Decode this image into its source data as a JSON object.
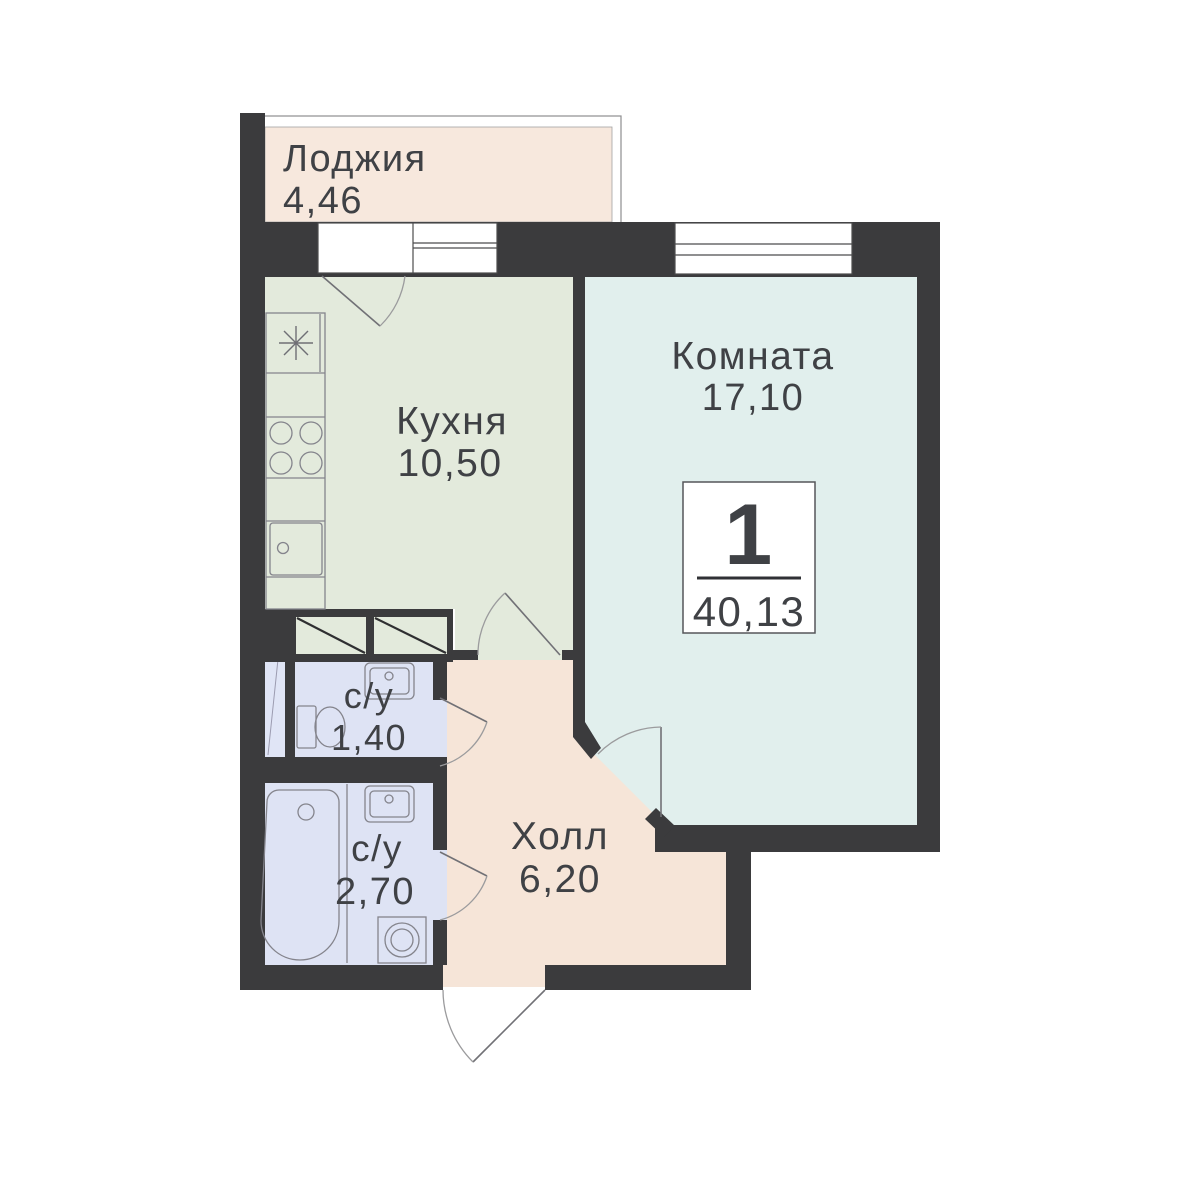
{
  "plan": {
    "type": "apartment-floor-plan",
    "badge": {
      "rooms_count": "1",
      "total_area": "40,13"
    },
    "rooms": [
      {
        "key": "loggia",
        "label": "Лоджия",
        "area": "4,46",
        "fill": "#f7e8dd"
      },
      {
        "key": "kitchen",
        "label": "Кухня",
        "area": "10,50",
        "fill": "#e3eadc"
      },
      {
        "key": "living-room",
        "label": "Комната",
        "area": "17,10",
        "fill": "#e1efed"
      },
      {
        "key": "bathroom-small",
        "label": "с/у",
        "area": "1,40",
        "fill": "#dee3f4"
      },
      {
        "key": "bathroom-large",
        "label": "с/у",
        "area": "2,70",
        "fill": "#dee3f4"
      },
      {
        "key": "hall",
        "label": "Холл",
        "area": "6,20",
        "fill": "#f6e5d8"
      }
    ],
    "colors": {
      "wall": "#3b3b3d",
      "background": "#ffffff",
      "text": "#3f4145",
      "fixture_stroke": "#84848c",
      "shaft_fill": "#e0e5f6"
    }
  }
}
